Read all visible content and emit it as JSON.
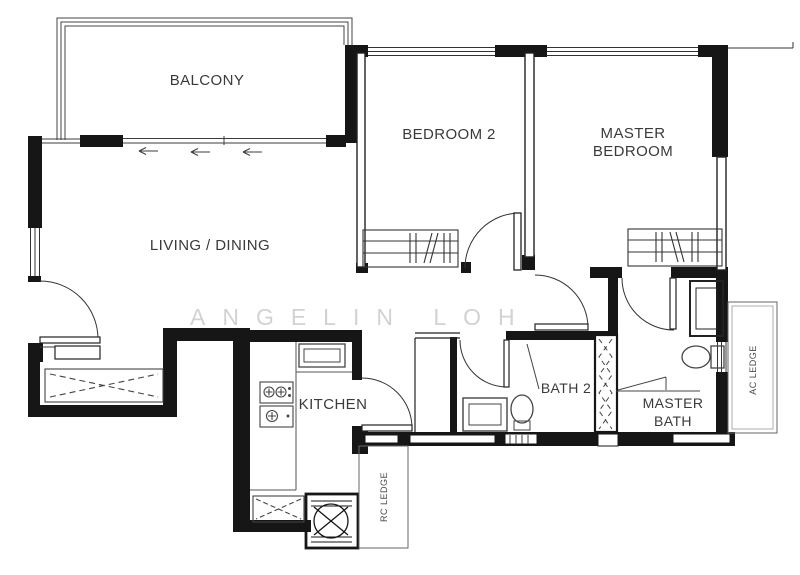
{
  "floorplan": {
    "watermark": "ANGELIN LOH",
    "labels": {
      "balcony": "BALCONY",
      "bedroom2": "BEDROOM 2",
      "master_bedroom_1": "MASTER",
      "master_bedroom_2": "BEDROOM",
      "living_dining": "LIVING / DINING",
      "kitchen": "KITCHEN",
      "bath2": "BATH 2",
      "master_bath_1": "MASTER",
      "master_bath_2": "BATH",
      "ac_ledge": "AC LEDGE",
      "rc_ledge": "RC LEDGE"
    },
    "colors": {
      "wall": "#161616",
      "line": "#3c3c3c",
      "light_line": "#6a6a6a",
      "watermark": "#b5b5b5",
      "background": "#ffffff"
    }
  }
}
